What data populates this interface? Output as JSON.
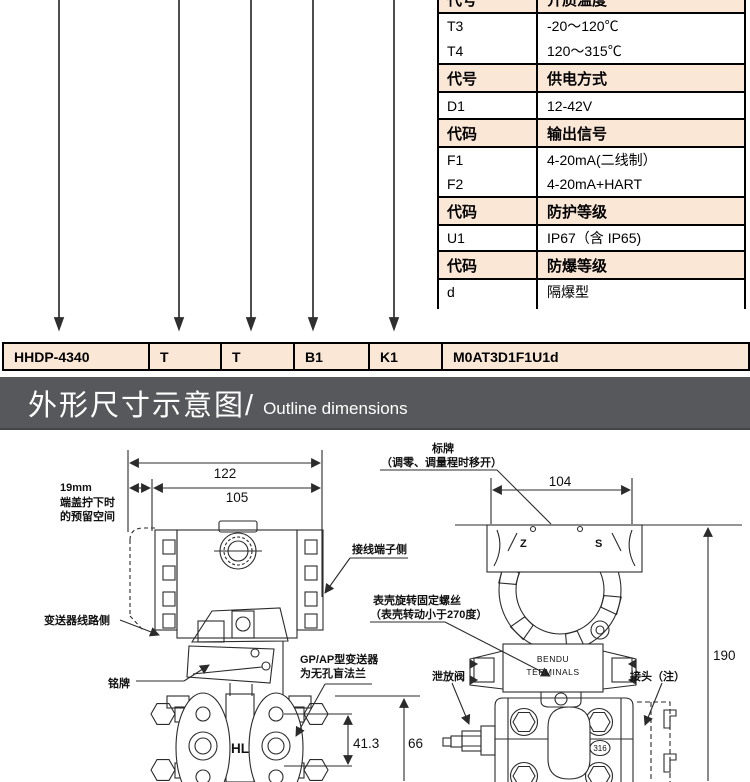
{
  "part_table": {
    "rows": [
      {
        "code": "代号",
        "value": "介质温度",
        "header": true
      },
      {
        "code": "T3",
        "value": "-20～120℃",
        "header": false
      },
      {
        "code": "T4",
        "value": "120～315℃",
        "header": false
      },
      {
        "code": "代号",
        "value": "供电方式",
        "header": true
      },
      {
        "code": "D1",
        "value": "12-42V",
        "header": false
      },
      {
        "code": "代码",
        "value": "输出信号",
        "header": true
      },
      {
        "code": "F1",
        "value": "4-20mA(二线制）",
        "header": false
      },
      {
        "code": "F2",
        "value": "4-20mA+HART",
        "header": false
      },
      {
        "code": "代码",
        "value": "防护等级",
        "header": true
      },
      {
        "code": "U1",
        "value": "IP67（含 IP65)",
        "header": false
      },
      {
        "code": "代码",
        "value": "防爆等级",
        "header": true
      },
      {
        "code": "d",
        "value": "隔爆型",
        "header": false
      },
      {
        "code": "c",
        "value": "无",
        "header": false
      }
    ]
  },
  "model_row": {
    "cells": [
      "HHDP-4340",
      "T",
      "T",
      "B1",
      "K1",
      "M0AT3D1F1U1d"
    ]
  },
  "banner": {
    "title_cn": "外形尺寸示意图/",
    "title_en": "Outline dimensions"
  },
  "drawing": {
    "front": {
      "dim_total": "122",
      "dim_body": "105",
      "cover_note_l1": "19mm",
      "cover_note_l2": "端盖拧下时",
      "cover_note_l3": "的预留空间",
      "label_circuit": "变送器线路侧",
      "label_terminal": "接线端子侧",
      "label_nameplate": "铭牌",
      "label_flange_l1": "GP/AP型变送器",
      "label_flange_l2": "为无孔盲法兰",
      "hl": "HL",
      "dim_bolts": "41.3",
      "dim_flange": "66"
    },
    "side": {
      "tag_l1": "标牌",
      "tag_l2": "（调零、调量程时移开）",
      "dim_top": "104",
      "z": "Z",
      "s": "S",
      "screw_l1": "表壳旋转固定螺丝",
      "screw_l2": "（表壳转动小于270度）",
      "vent": "泄放阀",
      "joint": "接头（注）",
      "terminal_l1": "BENDU",
      "terminal_l2": "TERMINALS",
      "steel": "316",
      "dim_height": "190"
    }
  },
  "colors": {
    "header_bg": "#fbe7d6",
    "banner_bg": "#57585b",
    "border": "#000000",
    "line": "#2b2b2b"
  }
}
